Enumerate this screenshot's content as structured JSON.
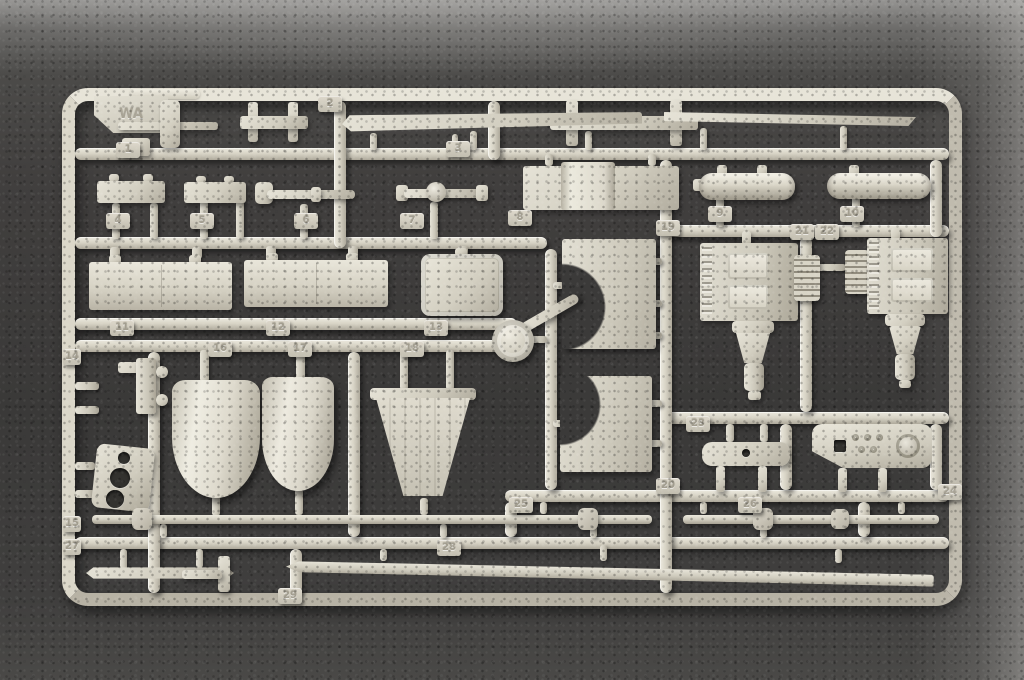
{
  "scene": {
    "type": "photograph",
    "description": "Light grey injection-moulded plastic model kit sprue (runner frame) holding parts numbered 1-29, photographed on dark grey felt; lighter grey surface visible along top and right edges",
    "colors": {
      "background_felt": "#3e3d3c",
      "background_light_edge": "#9a9997",
      "plastic_base": "#d6d2c4",
      "plastic_highlight": "#ece9de",
      "plastic_shadow": "#a39e90"
    }
  },
  "sprue": {
    "corner_mark": "WA",
    "tabs": [
      {
        "n": "1"
      },
      {
        "n": "2"
      },
      {
        "n": "3"
      },
      {
        "n": "4"
      },
      {
        "n": "5"
      },
      {
        "n": "6"
      },
      {
        "n": "7"
      },
      {
        "n": "8"
      },
      {
        "n": "9"
      },
      {
        "n": "10"
      },
      {
        "n": "11"
      },
      {
        "n": "12"
      },
      {
        "n": "13"
      },
      {
        "n": "14"
      },
      {
        "n": "15"
      },
      {
        "n": "16"
      },
      {
        "n": "17"
      },
      {
        "n": "18"
      },
      {
        "n": "19"
      },
      {
        "n": "20"
      },
      {
        "n": "21"
      },
      {
        "n": "22"
      },
      {
        "n": "23"
      },
      {
        "n": "24"
      },
      {
        "n": "25"
      },
      {
        "n": "26"
      },
      {
        "n": "27"
      },
      {
        "n": "28"
      },
      {
        "n": "29"
      }
    ],
    "parts": [
      "lever-assembly",
      "small-clamp-bracket",
      "large-clamp-bracket",
      "long-blade-upper-left",
      "long-blade-upper-right",
      "bar-plate-4",
      "bar-plate-5",
      "jointed-rod-6",
      "ball-joint-link-7",
      "box-with-hump-8",
      "cylindrical-tank-9",
      "cylindrical-tank-10",
      "twin-panel-11",
      "twin-panel-12",
      "rounded-box-13",
      "crescent-plate-upper",
      "crescent-plate-lower",
      "angled-pipe",
      "round-cap",
      "gearbox-assembly-21",
      "gearbox-assembly-22",
      "mounting-bracket-14",
      "plate-with-holes-15",
      "fender-shell-16",
      "fender-shell-17",
      "ribbed-hopper-18",
      "two-leg-bracket-23",
      "instrument-panel-24",
      "torsion-rod-25",
      "torsion-rod-26",
      "thin-strip-27",
      "tee-bracket-29",
      "long-side-blade-28"
    ]
  }
}
